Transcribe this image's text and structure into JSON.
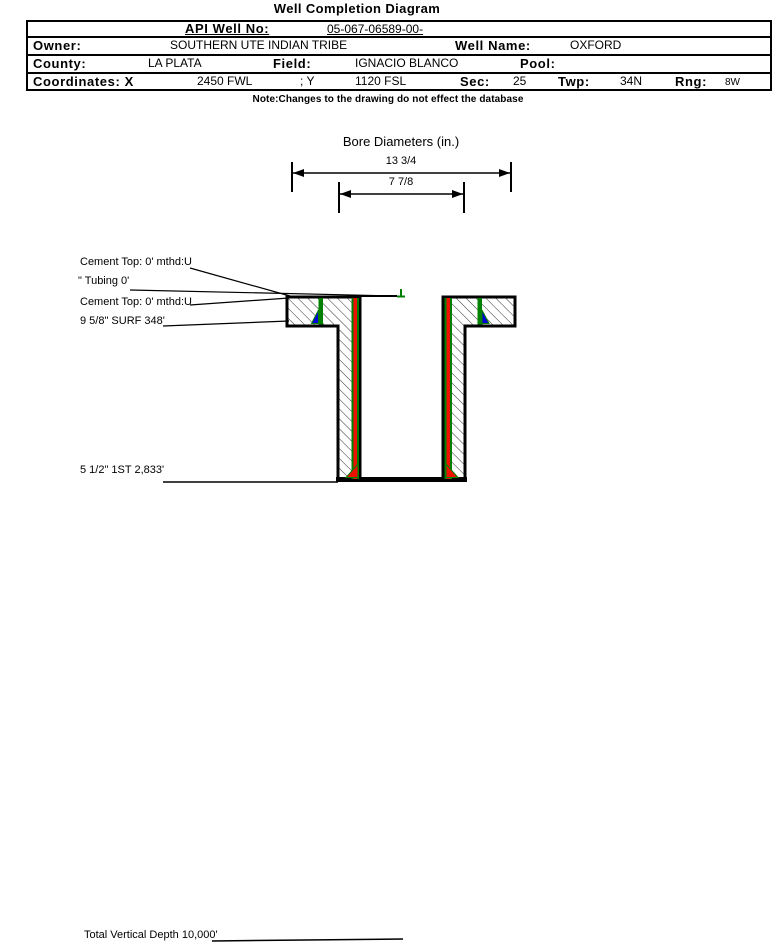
{
  "title": "Well Completion Diagram",
  "header": {
    "api_label": "API Well No:",
    "api_value": "05-067-06589-00-",
    "owner_label": "Owner:",
    "owner_value": "SOUTHERN UTE INDIAN TRIBE",
    "well_name_label": "Well Name:",
    "well_name_value": "OXFORD",
    "county_label": "County:",
    "county_value": "LA PLATA",
    "field_label": "Field:",
    "field_value": "IGNACIO BLANCO",
    "pool_label": "Pool:",
    "pool_value": "",
    "coordinates_label": "Coordinates: X",
    "coordinates_x_value": "2450 FWL",
    "coordinates_y_label": "; Y",
    "coordinates_y_value": "1120 FSL",
    "sec_label": "Sec:",
    "sec_value": "25",
    "twp_label": "Twp:",
    "twp_value": "34N",
    "rng_label": "Rng:",
    "rng_value": "8W"
  },
  "note": "Note:Changes to the drawing do not effect the database",
  "diagram": {
    "bore_title": "Bore Diameters (in.)",
    "outer_diameter": "13 3/4",
    "inner_diameter": "7 7/8",
    "annotations": {
      "cement_top_1": "Cement Top: 0' mthd:U",
      "tubing": "\" Tubing 0'",
      "cement_top_2": "Cement Top: 0' mthd:U",
      "surface_casing": "9 5/8\" SURF 348'",
      "production_casing": "5 1/2\" 1ST 2,833'",
      "total_depth": "Total Vertical Depth 10,000'"
    }
  },
  "colors": {
    "casing_green": "#008000",
    "cement_red": "#ee1100",
    "shoe_blue": "#0000dd",
    "line_black": "#000000"
  }
}
